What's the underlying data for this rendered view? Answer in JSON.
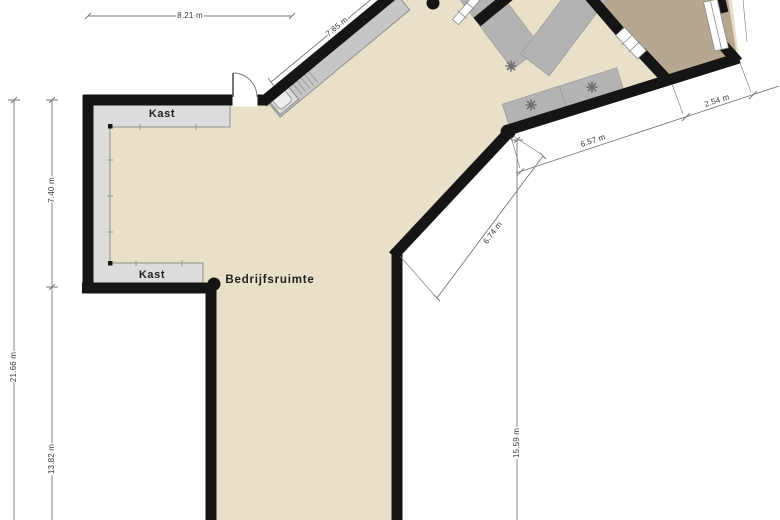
{
  "floorplan": {
    "rooms": {
      "main": {
        "label": "Bedrijfsruimte"
      },
      "closet_top": {
        "label": "Kast"
      },
      "closet_bottom": {
        "label": "Kast"
      }
    },
    "dimensions": {
      "top_width": "8.21 m",
      "upper_diagonal_wall": "7.65 m",
      "left_upper": "7.40 m",
      "left_total": "21.66 m",
      "left_lower": "13.82 m",
      "right_diagonal_main": "6.57 m",
      "right_diagonal_upper": "2.54 m",
      "lower_right_diagonal": "6.74 m",
      "right_vertical": "15.59 m"
    },
    "icons": {
      "plant_symbol": "✳"
    },
    "colors": {
      "background": "#ffffff",
      "floor": "#e8e0c8",
      "room2_floor": "#b6a791",
      "closet": "#dcdcdc",
      "wall": "#151515",
      "furniture": "#b3b3b3",
      "counter": "#c6c6c6",
      "dimension_line": "#777777"
    }
  }
}
